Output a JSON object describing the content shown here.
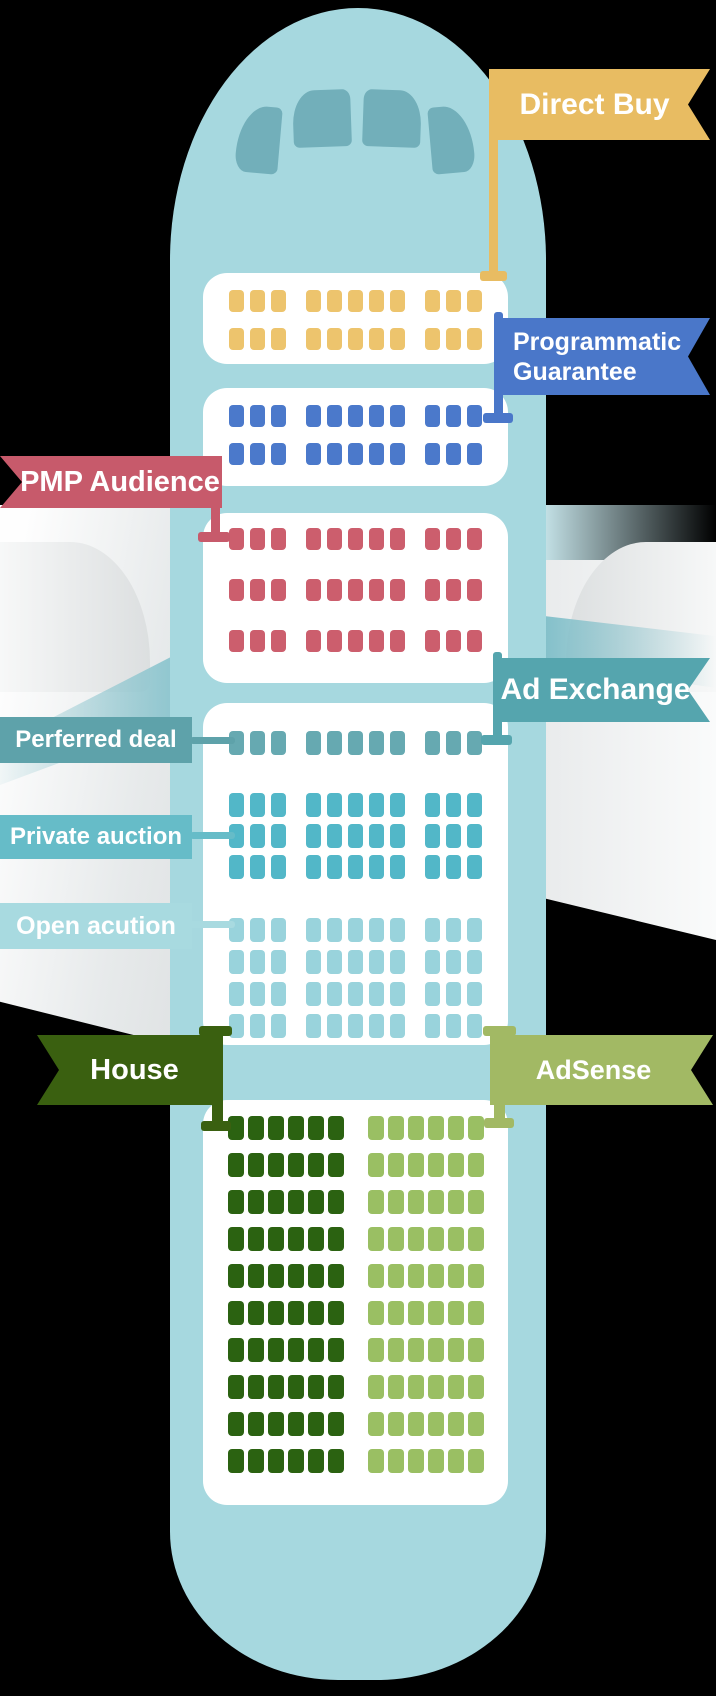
{
  "colors": {
    "background": "#000000",
    "fuselage": "#A6D8DF",
    "cockpit_window": "#72AFBA",
    "cabin_white": "#FFFFFF"
  },
  "flags": {
    "direct_buy": {
      "label": "Direct Buy",
      "color": "#E8BC62"
    },
    "programmatic_guarantee": {
      "line1": "Programmatic",
      "line2": "Guarantee",
      "color": "#4A77C9"
    },
    "pmp_audience": {
      "label": "PMP Audience",
      "color": "#C75A6B"
    },
    "ad_exchange": {
      "label": "Ad Exchange",
      "color": "#55A5AE"
    },
    "house": {
      "label": "House",
      "color": "#3A6010"
    },
    "adsense": {
      "label": "AdSense",
      "color": "#A2B964"
    }
  },
  "side_labels": {
    "preferred_deal": {
      "label": "Perferred deal",
      "color": "#5EA2AA"
    },
    "private_auction": {
      "label": "Private auction",
      "color": "#66BCC8"
    },
    "open_auction": {
      "label": "Open acution",
      "color": "#A8DAE0"
    }
  },
  "cabin_sections": [
    {
      "id": "direct-buy",
      "layout": [
        3,
        5,
        3
      ],
      "row_groups": [
        {
          "rows": 2,
          "seat_color": "#EDC46D"
        }
      ]
    },
    {
      "id": "programmatic-guarantee",
      "layout": [
        3,
        5,
        3
      ],
      "row_groups": [
        {
          "rows": 2,
          "seat_color": "#4B79CB"
        }
      ]
    },
    {
      "id": "pmp-audience",
      "layout": [
        3,
        5,
        3
      ],
      "row_groups": [
        {
          "rows": 3,
          "seat_color": "#CC5E6D"
        }
      ]
    },
    {
      "id": "ad-exchange",
      "layout": [
        3,
        5,
        3
      ],
      "row_groups": [
        {
          "rows": 1,
          "seat_color": "#66A9B1"
        },
        {
          "rows": 3,
          "seat_color": "#52B7C8"
        },
        {
          "rows": 4,
          "seat_color": "#99D3DC"
        }
      ]
    },
    {
      "id": "house-adsense",
      "layout": [
        6,
        6
      ],
      "row_groups": [
        {
          "rows": 10,
          "seat_color": [
            "#2B6211",
            "#9ABF63"
          ]
        }
      ]
    }
  ]
}
